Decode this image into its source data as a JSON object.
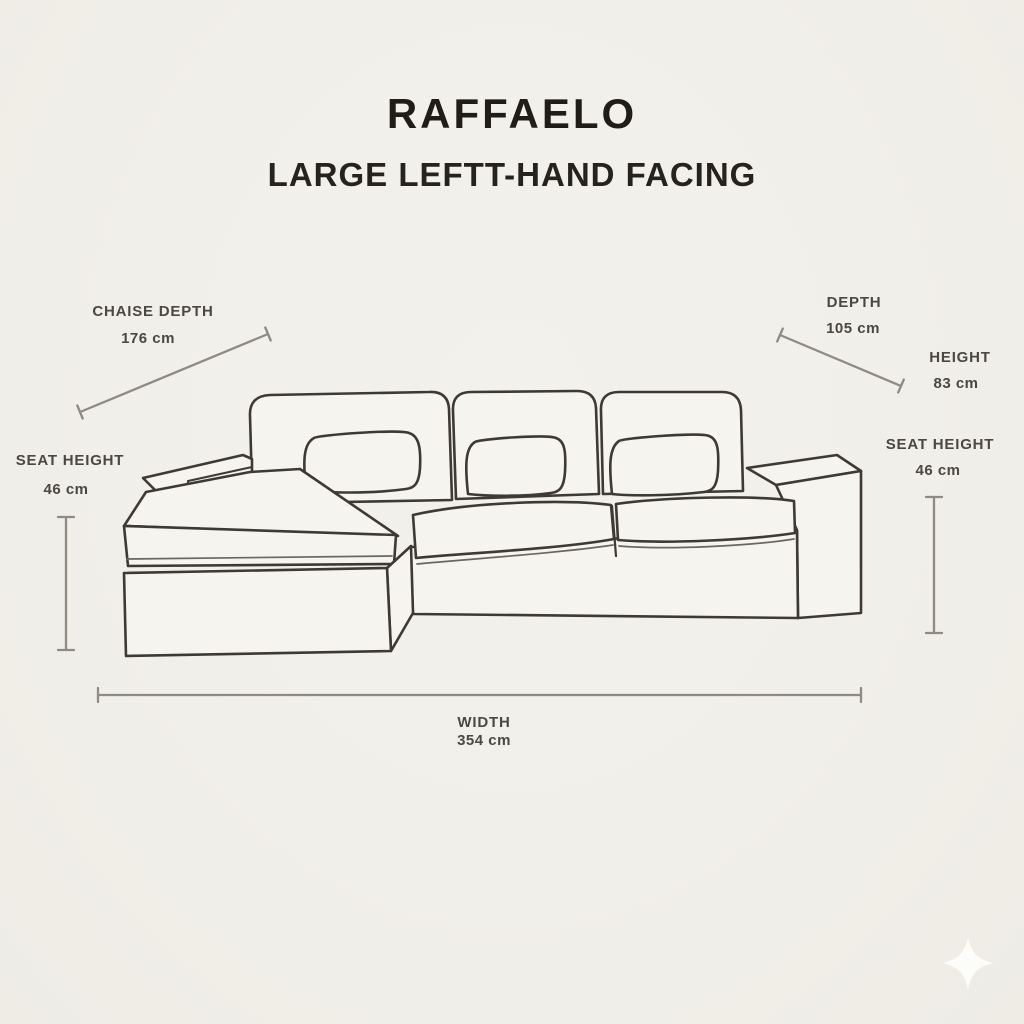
{
  "header": {
    "title": "RAFFAELO",
    "subtitle": "LARGE LEFTT-HAND FACING"
  },
  "figure": {
    "name": "sectional-sofa-line-drawing",
    "style": "hand-drawn outline, three back cushions, three lumbar pillows, left-hand chaise"
  },
  "dimensions": {
    "chaise_depth": {
      "label": "CHAISE DEPTH",
      "value": "176 cm"
    },
    "depth": {
      "label": "DEPTH",
      "value": "105 cm"
    },
    "height": {
      "label": "HEIGHT",
      "value": "83 cm"
    },
    "seat_height_left": {
      "label": "SEAT HEIGHT",
      "value": "46 cm"
    },
    "seat_height_right": {
      "label": "SEAT HEIGHT",
      "value": "46 cm"
    },
    "width": {
      "label": "WIDTH",
      "value": "354 cm"
    }
  },
  "icons": {
    "sparkle": "four-pointed-star"
  },
  "colors": {
    "background": "#f1efe9",
    "line_art": "#3e3a33",
    "dimension_line": "#8f8b83",
    "label_text": "#4b4742",
    "title_text": "#201d17",
    "sparkle": "#fcfcf8"
  }
}
